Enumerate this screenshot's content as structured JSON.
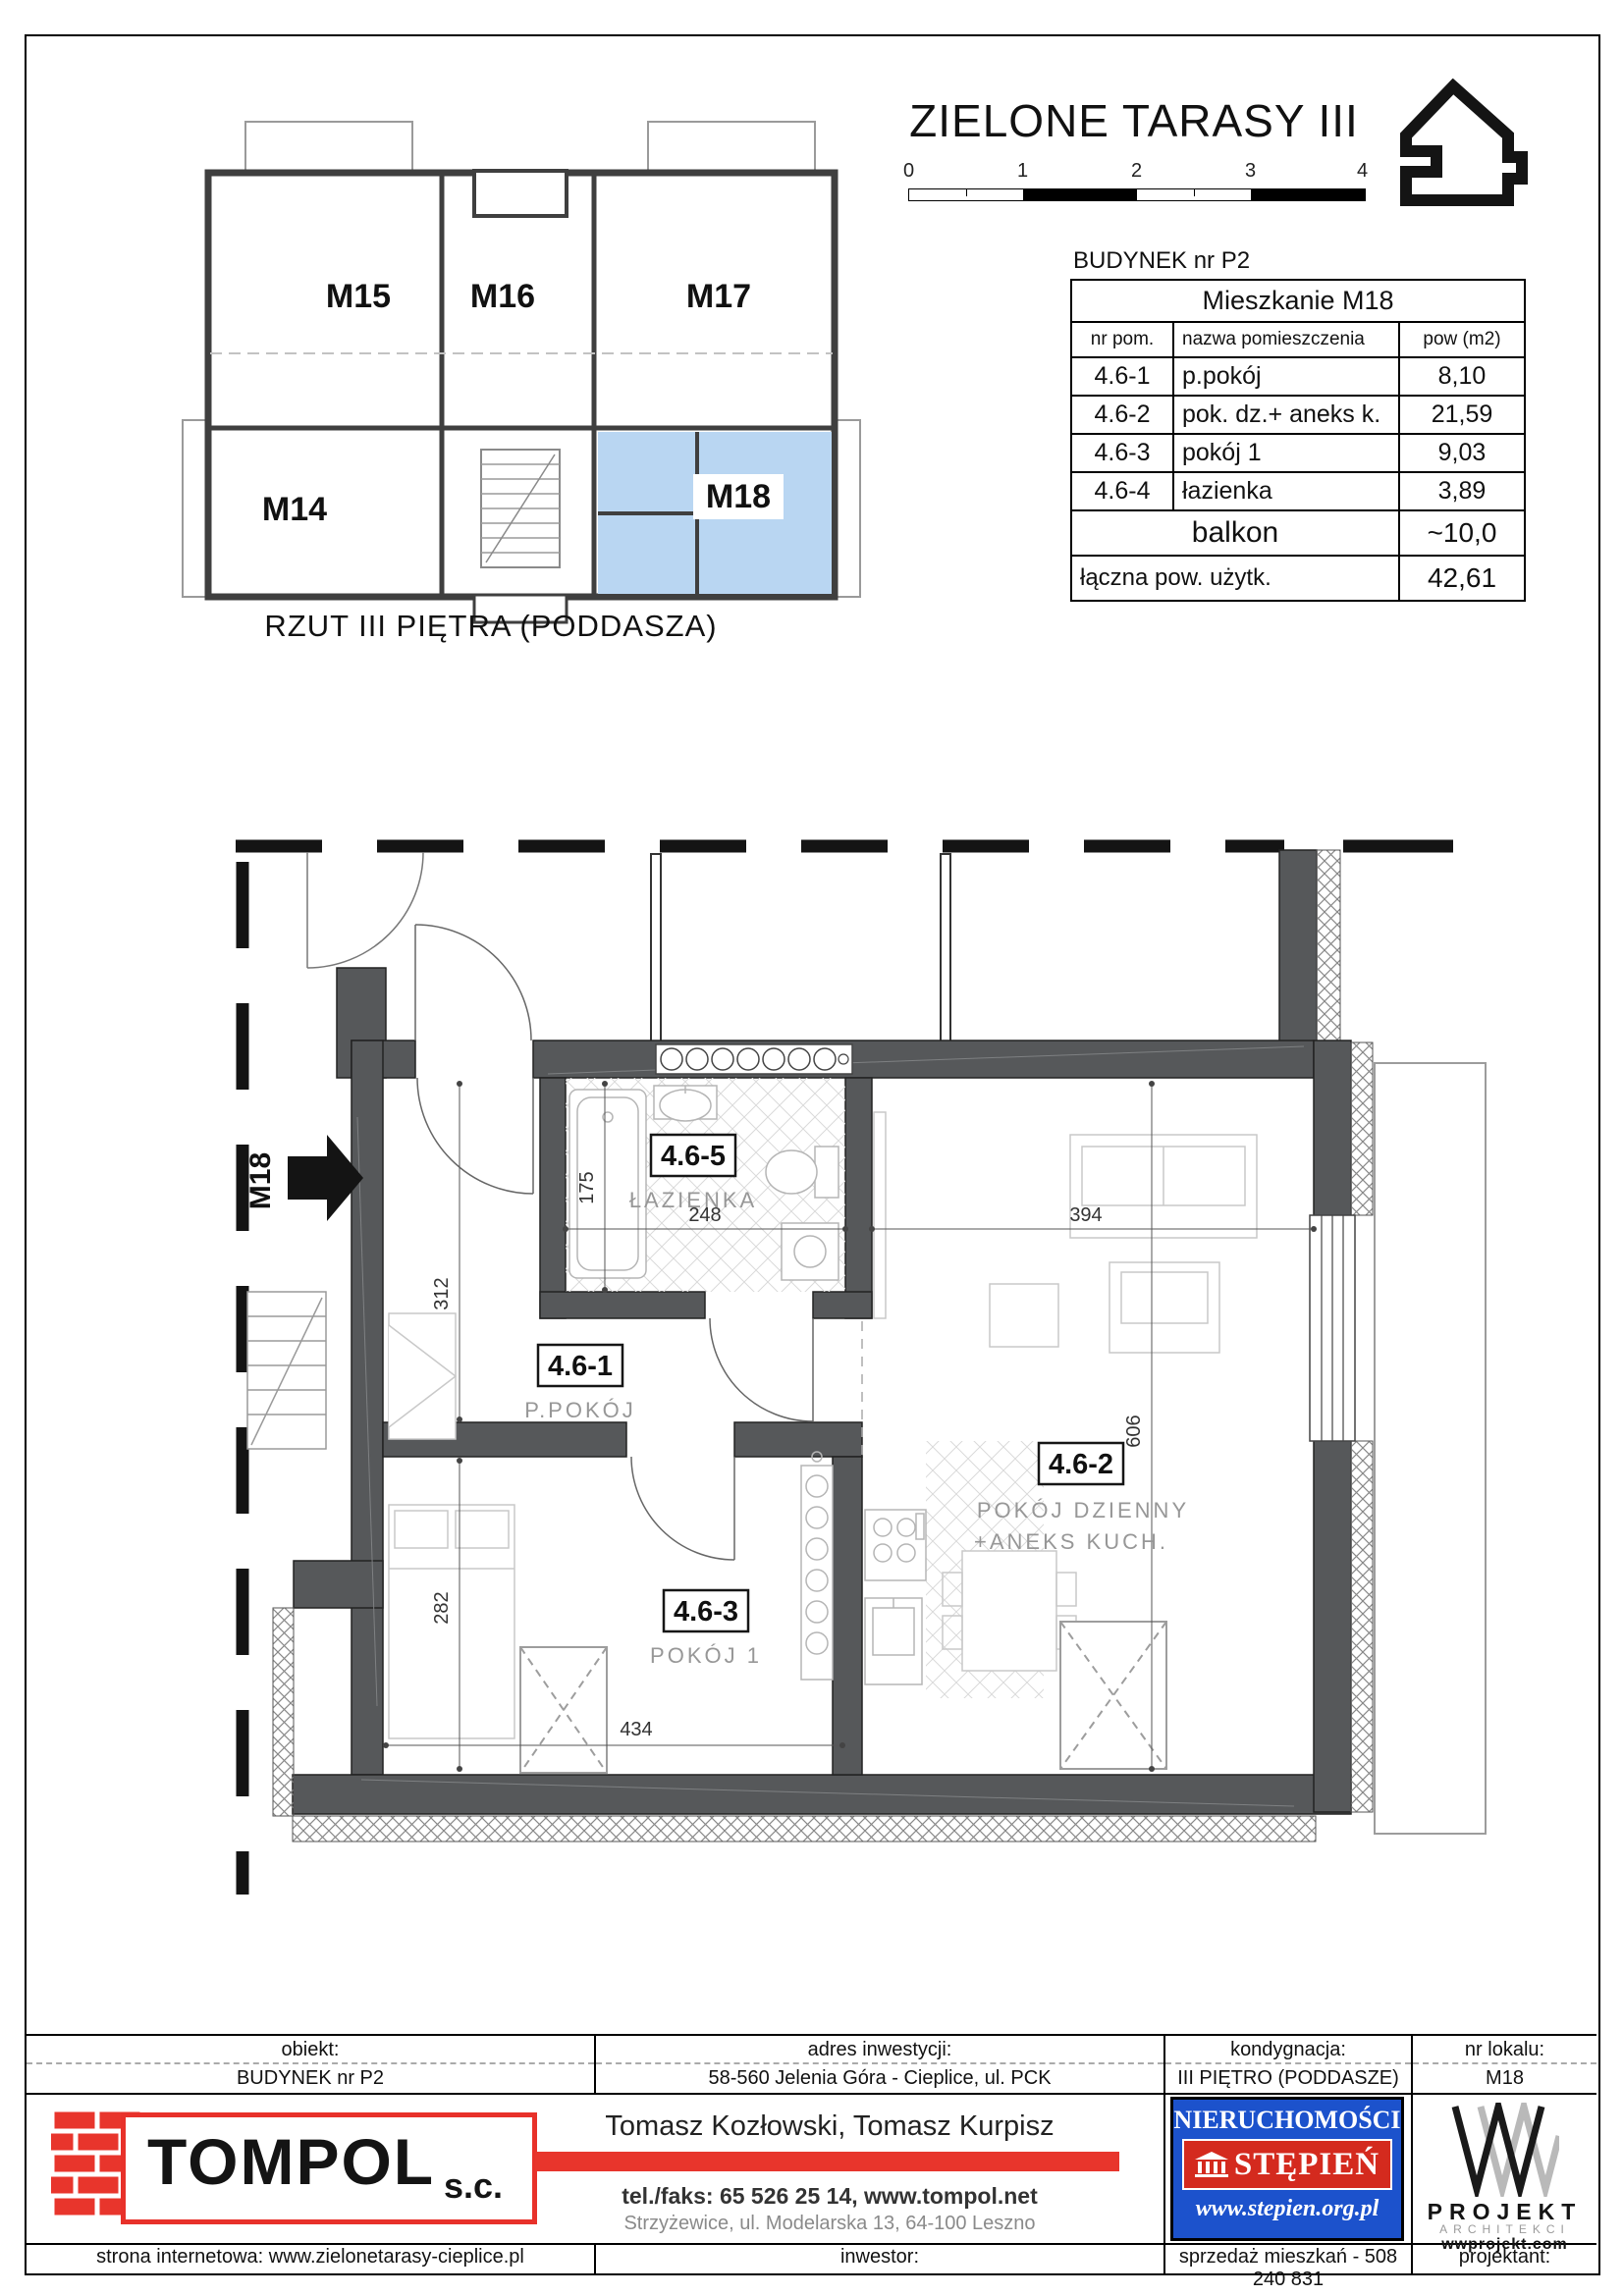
{
  "header": {
    "title": "ZIELONE TARASY III",
    "scale_ticks": [
      "0",
      "1",
      "2",
      "3",
      "4"
    ],
    "overview_caption": "RZUT III PIĘTRA (PODDASZA)"
  },
  "overview_units": {
    "m14": "M14",
    "m15": "M15",
    "m16": "M16",
    "m17": "M17",
    "m18": "M18"
  },
  "apartment_table": {
    "building": "BUDYNEK nr P2",
    "title": "Mieszkanie  M18",
    "columns": {
      "nr": "nr pom.",
      "name": "nazwa pomieszczenia",
      "area": "pow (m2)"
    },
    "rows": [
      {
        "nr": "4.6-1",
        "name": "p.pokój",
        "area": "8,10"
      },
      {
        "nr": "4.6-2",
        "name": "pok. dz.+ aneks k.",
        "area": "21,59"
      },
      {
        "nr": "4.6-3",
        "name": "pokój 1",
        "area": "9,03"
      },
      {
        "nr": "4.6-4",
        "name": "łazienka",
        "area": "3,89"
      }
    ],
    "balcony_row": {
      "name": "balkon",
      "area": "~10,0"
    },
    "total_row": {
      "name": "łączna pow. użytk.",
      "area": "42,61"
    }
  },
  "plan": {
    "entry_label": "M18",
    "rooms": {
      "hall": {
        "code": "4.6-1",
        "name": "P.POKÓJ"
      },
      "living": {
        "code": "4.6-2",
        "name_line1": "POKÓJ DZIENNY",
        "name_line2": "+ANEKS KUCH."
      },
      "room1": {
        "code": "4.6-3",
        "name": "POKÓJ 1"
      },
      "bath": {
        "code": "4.6-5",
        "name": "ŁAZIENKA"
      }
    },
    "dims": {
      "bath_h": "175",
      "bath_w": "248",
      "hall_h": "312",
      "living_w": "394",
      "living_h": "606",
      "room1_h": "282",
      "room1_w": "434"
    },
    "highlight_color": "#b9d6f2"
  },
  "footer": {
    "row1": [
      {
        "label": "obiekt:",
        "value": "BUDYNEK nr P2"
      },
      {
        "label": "adres inwestycji:",
        "value": "58-560 Jelenia Góra - Cieplice, ul. PCK"
      },
      {
        "label": "kondygnacja:",
        "value": "III PIĘTRO (PODDASZE)"
      },
      {
        "label": "nr lokalu:",
        "value": "M18"
      }
    ],
    "tompol": {
      "name": "TOMPOL",
      "suffix": "s.c."
    },
    "company": {
      "owners": "Tomasz Kozłowski, Tomasz Kurpisz",
      "phone": "tel./faks: 65 526 25 14,  www.tompol.net",
      "address": "Strzyżewice, ul. Modelarska 13, 64-100 Leszno"
    },
    "stepien": {
      "line1": "NIERUCHOMOŚCI",
      "line2": "STĘPIEŃ",
      "url": "www.stepien.org.pl"
    },
    "wprojekt": {
      "name": "PROJEKT",
      "sub": "ARCHITEKCI",
      "url": "wwprojekt.com"
    },
    "row3": [
      "strona internetowa: www.zielonetarasy-cieplice.pl",
      "inwestor:",
      "sprzedaż mieszkań - 508 240 831",
      "projektant:"
    ]
  }
}
